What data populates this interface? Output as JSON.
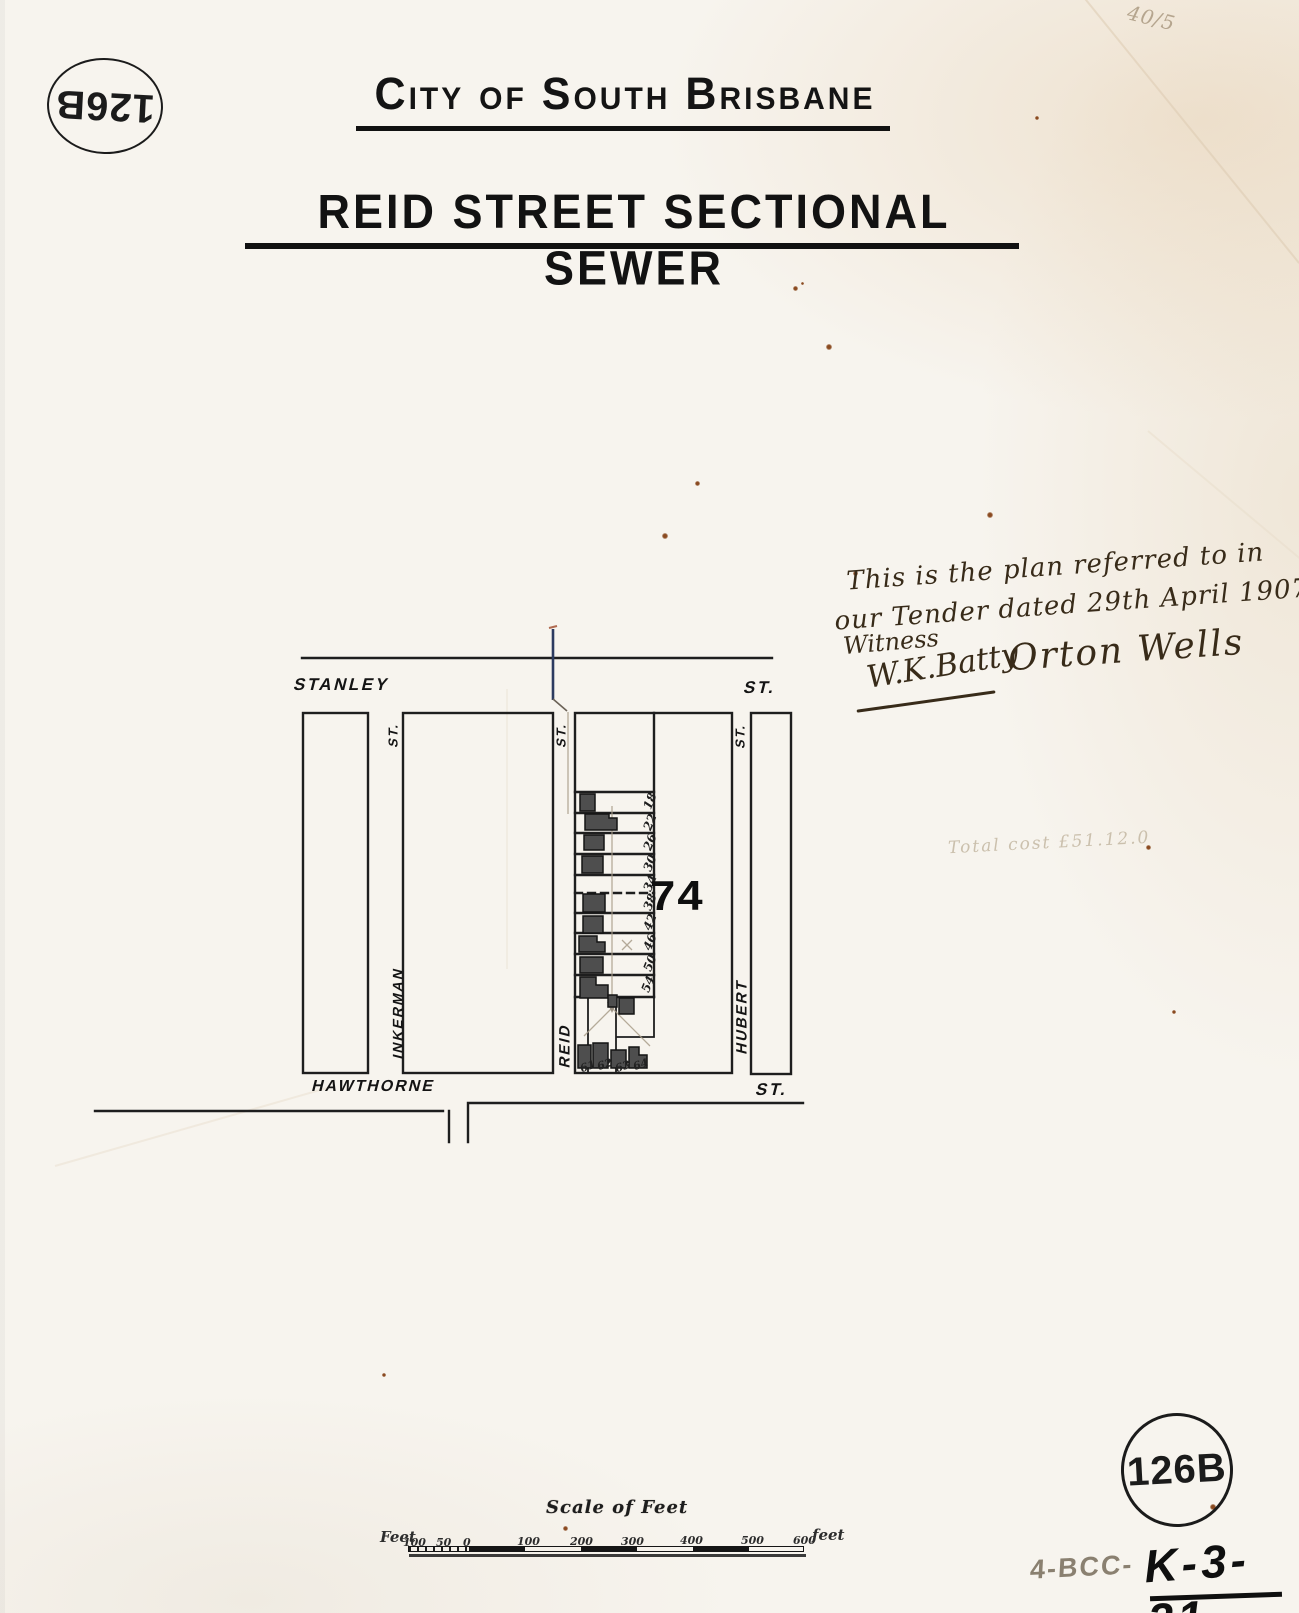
{
  "stamps": {
    "top_left": "126B",
    "bottom_right": "126B"
  },
  "header": {
    "title": "City of South Brisbane",
    "subtitle": "REID STREET SECTIONAL SEWER"
  },
  "annotations": {
    "corner_note": "40/5",
    "tender_note_line1": "This is the plan referred to in",
    "tender_note_line2": "our Tender dated 29th April 1907",
    "witness_label": "Witness",
    "signature_witness": "W.K.Batty",
    "signature_contractor": "Orton Wells",
    "pencil_cost_note": "Total cost £51.12.0",
    "reference_pencil": "4-BCC-",
    "reference_ink": "K-3-21"
  },
  "map": {
    "streets": {
      "stanley": "STANLEY",
      "stanley_st": "ST.",
      "hawthorne": "HAWTHORNE",
      "hawthorne_st": "ST.",
      "inkerman": "INKERMAN",
      "inkerman_st": "ST.",
      "reid": "REID",
      "reid_st": "ST.",
      "hubert": "HUBERT",
      "hubert_st": "ST."
    },
    "allotment_number": "74",
    "lot_numbers": [
      "18",
      "22",
      "26",
      "30",
      "34",
      "38",
      "42",
      "46",
      "50",
      "54"
    ],
    "bottom_lot_numbers": [
      "61",
      "62",
      "63",
      "64"
    ]
  },
  "scale_bar": {
    "title": "Scale of Feet",
    "left_unit": "Feet",
    "right_unit": "feet",
    "ticks": [
      "100",
      "50",
      "0",
      "100",
      "200",
      "300",
      "400",
      "500",
      "600"
    ]
  }
}
